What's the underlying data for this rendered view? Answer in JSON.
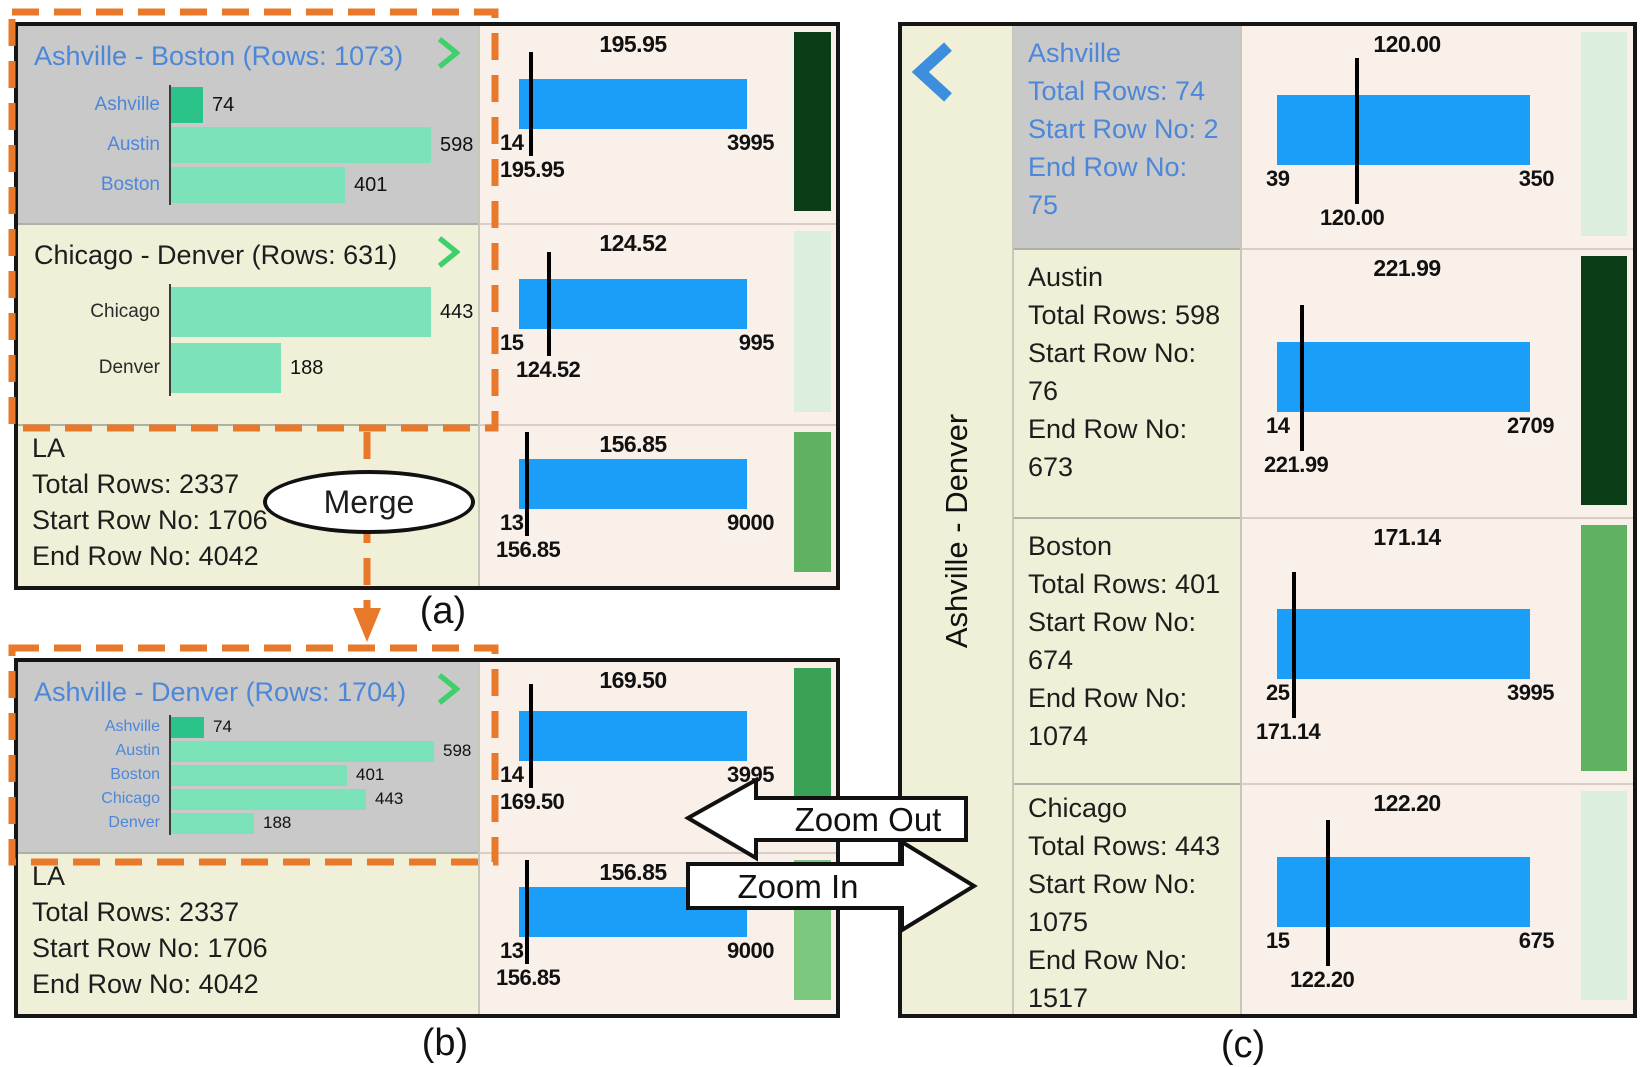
{
  "colors": {
    "beige_bg": "#F0F0D8",
    "selected_gray": "#C9C9C9",
    "chart_bg": "#FAF0EA",
    "blue_bar": "#1B9EF7",
    "mint_bar": "#7CE2B9",
    "teal_bar": "#2BC389",
    "blue_text": "#4C87D9",
    "green_chevron": "#3ED06A",
    "blue_chevron": "#3E8EDE",
    "orange_annotation": "#E8782A",
    "strip_dark_green": "#0B3D16",
    "strip_pale_green": "#DCEEDC",
    "strip_medium_green": "#5FB262",
    "strip_green": "#3AA257",
    "strip_light_medium_green": "#7CC87F"
  },
  "panel_a": {
    "label": "(a)",
    "groups": [
      {
        "title": "Ashville - Boston (Rows: 1073)",
        "bars": [
          {
            "label": "Ashville",
            "value": "74"
          },
          {
            "label": "Austin",
            "value": "598"
          },
          {
            "label": "Boston",
            "value": "401"
          }
        ],
        "chart": {
          "top": "195.95",
          "min": "14",
          "max": "3995",
          "marker": "195.95"
        }
      },
      {
        "title": "Chicago - Denver (Rows: 631)",
        "bars": [
          {
            "label": "Chicago",
            "value": "443"
          },
          {
            "label": "Denver",
            "value": "188"
          }
        ],
        "chart": {
          "top": "124.52",
          "min": "15",
          "max": "995",
          "marker": "124.52"
        }
      }
    ],
    "summary": {
      "lines": [
        "LA",
        "Total Rows: 2337",
        "Start Row No: 1706",
        "End Row No: 4042"
      ],
      "chart": {
        "top": "156.85",
        "min": "13",
        "max": "9000",
        "marker": "156.85"
      }
    }
  },
  "panel_b": {
    "label": "(b)",
    "group": {
      "title": "Ashville - Denver (Rows: 1704)",
      "bars": [
        {
          "label": "Ashville",
          "value": "74"
        },
        {
          "label": "Austin",
          "value": "598"
        },
        {
          "label": "Boston",
          "value": "401"
        },
        {
          "label": "Chicago",
          "value": "443"
        },
        {
          "label": "Denver",
          "value": "188"
        }
      ],
      "chart": {
        "top": "169.50",
        "min": "14",
        "max": "3995",
        "marker": "169.50"
      }
    },
    "summary": {
      "lines": [
        "LA",
        "Total Rows: 2337",
        "Start Row No: 1706",
        "End Row No: 4042"
      ],
      "chart": {
        "top": "156.85",
        "min": "13",
        "max": "9000",
        "marker": "156.85"
      }
    }
  },
  "panel_c": {
    "label": "(c)",
    "vertical_title": "Ashville - Denver",
    "rows": [
      {
        "lines": [
          "Ashville",
          "Total Rows: 74",
          "Start Row No: 2",
          "End Row No:",
          "75"
        ],
        "chart": {
          "top": "120.00",
          "min": "39",
          "max": "350",
          "marker": "120.00"
        }
      },
      {
        "lines": [
          "Austin",
          "Total Rows: 598",
          "Start Row No:",
          "76",
          "End Row No:",
          "673"
        ],
        "chart": {
          "top": "221.99",
          "min": "14",
          "max": "2709",
          "marker": "221.99"
        }
      },
      {
        "lines": [
          "Boston",
          "Total Rows: 401",
          "Start Row No:",
          "674",
          "End Row No:",
          "1074"
        ],
        "chart": {
          "top": "171.14",
          "min": "25",
          "max": "3995",
          "marker": "171.14"
        }
      },
      {
        "lines": [
          "Chicago",
          "Total Rows: 443",
          "Start Row No:",
          "1075",
          "End Row No:",
          "1517"
        ],
        "chart": {
          "top": "122.20",
          "min": "15",
          "max": "675",
          "marker": "122.20"
        }
      }
    ]
  },
  "annotations": {
    "merge": "Merge",
    "zoom_out": "Zoom Out",
    "zoom_in": "Zoom In"
  }
}
